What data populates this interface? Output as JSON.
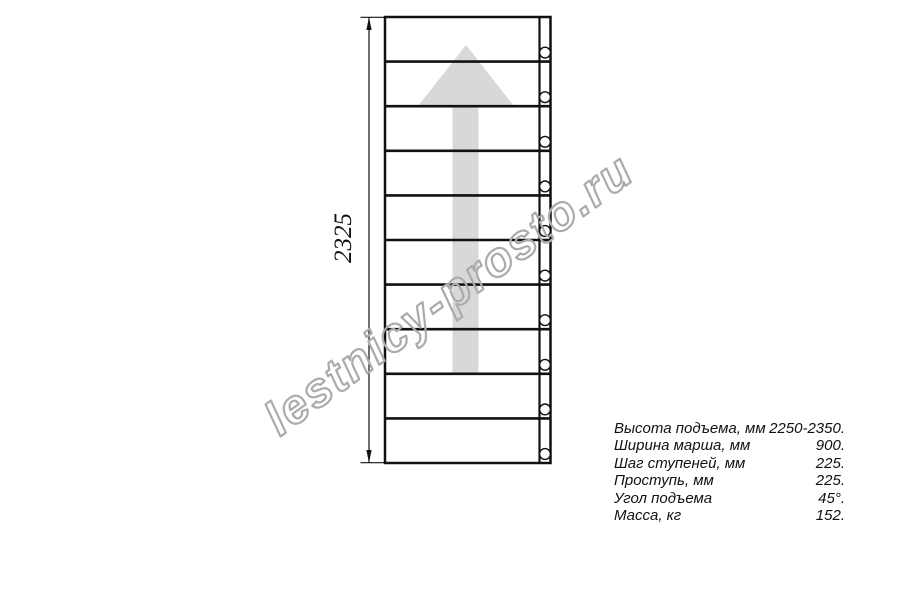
{
  "drawing": {
    "dimension_label": "2325",
    "steps_count": 10,
    "bolts_count": 10,
    "line_color": "#111111",
    "arrow_fill": "#d8d8d8",
    "direction": "up"
  },
  "watermark": {
    "text": "lestnicy-prosto.ru",
    "color": "#ababab"
  },
  "specs": {
    "rows": [
      {
        "label": "Высота подъема, мм",
        "value": "2250-2350."
      },
      {
        "label": "Ширина марша, мм",
        "value": "900."
      },
      {
        "label": "Шаг ступеней, мм",
        "value": "225."
      },
      {
        "label": "Проступь, мм",
        "value": "225."
      },
      {
        "label": "Угол подъема",
        "value": "45°."
      },
      {
        "label": "Масса, кг",
        "value": "152."
      }
    ]
  }
}
